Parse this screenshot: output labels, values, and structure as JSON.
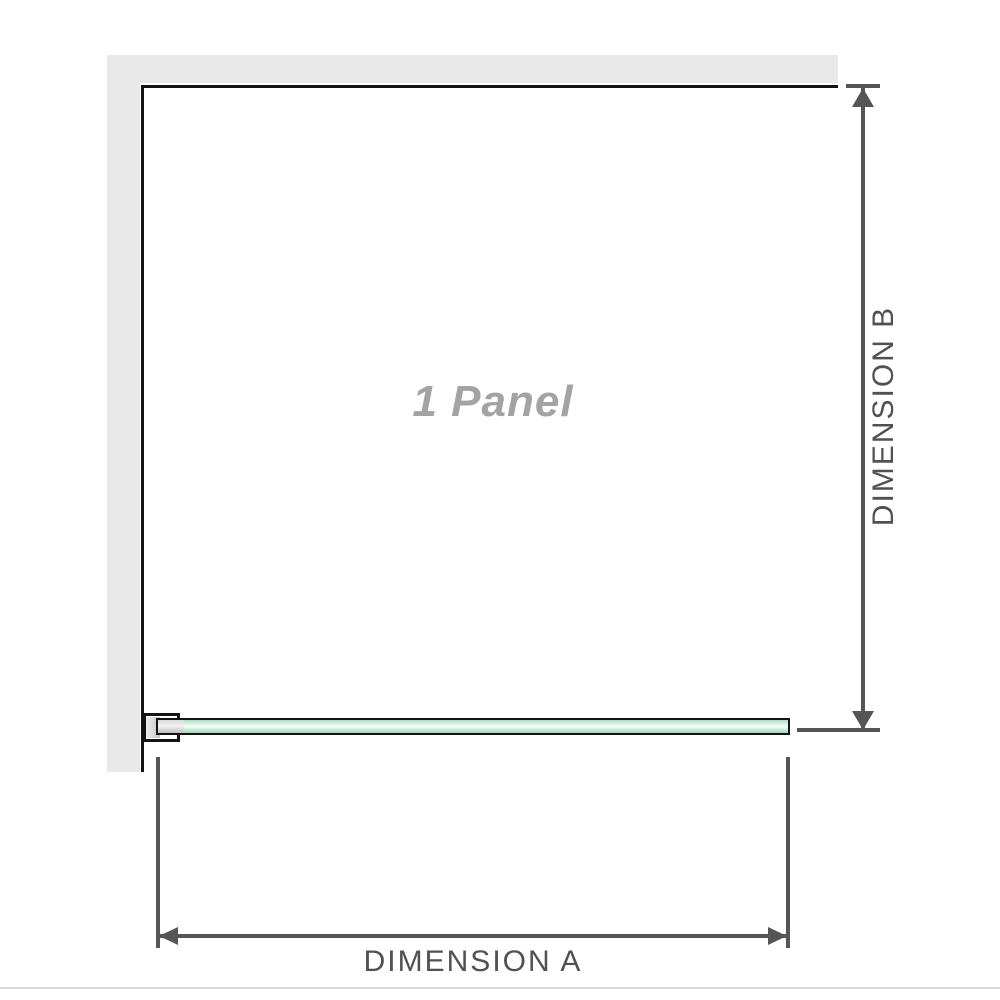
{
  "diagram": {
    "panel_label": "1 Panel",
    "dimension_a_label": "DIMENSION A",
    "dimension_b_label": "DIMENSION B"
  },
  "colors": {
    "wall": "#e9e9e9",
    "outline": "#141414",
    "dim": "#555555",
    "dimtext": "#515151",
    "panel-label": "#a3a3a3",
    "divider": "#dedbd3",
    "glass-top": "#a9ddc2",
    "glass-hi": "#f4fcf8",
    "glass-bot": "#9fd7b9"
  }
}
